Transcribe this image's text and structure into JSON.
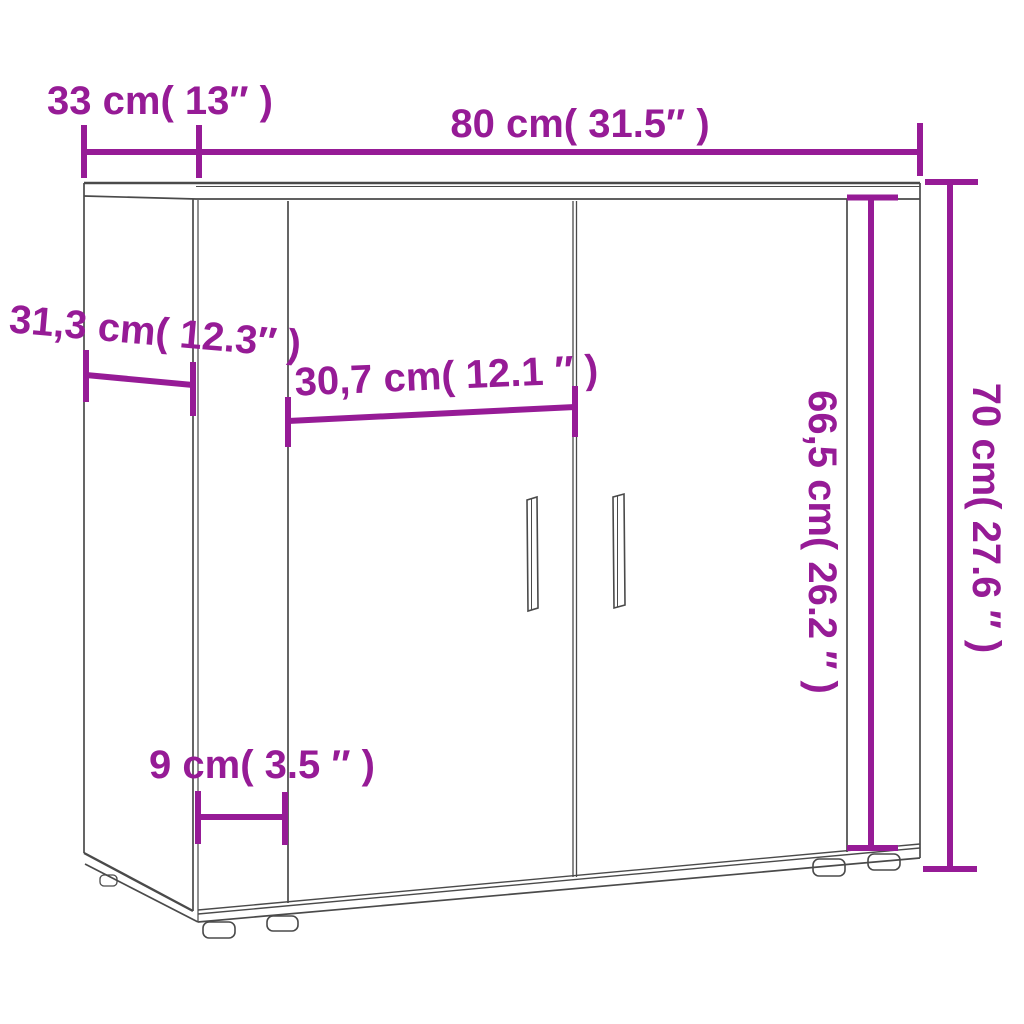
{
  "page": {
    "type": "product-dimension-diagram",
    "product": "two-door sideboard line drawing",
    "background": "#ffffff"
  },
  "colors": {
    "dimension": "#961B96",
    "outline": "#4a4a4a"
  },
  "dimensions": {
    "top_depth": {
      "label": "33 cm( 13″ )",
      "cm": "33",
      "inch": "13"
    },
    "top_width": {
      "label": "80 cm( 31.5″ )",
      "cm": "80",
      "inch": "31.5"
    },
    "side_depth": {
      "label": "31,3 cm( 12.3″ )",
      "cm": "31,3",
      "inch": "12.3"
    },
    "door_width": {
      "label": "30,7 cm( 12.1 ″ )",
      "cm": "30,7",
      "inch": "12.1"
    },
    "left_panel_width": {
      "label": "9 cm( 3.5 ″ )",
      "cm": "9",
      "inch": "3.5"
    },
    "door_height": {
      "label": "66,5 cm( 26.2 ″ )",
      "cm": "66,5",
      "inch": "26.2"
    },
    "total_height": {
      "label": "70 cm( 27.6 ″ )",
      "cm": "70",
      "inch": "27.6"
    }
  }
}
